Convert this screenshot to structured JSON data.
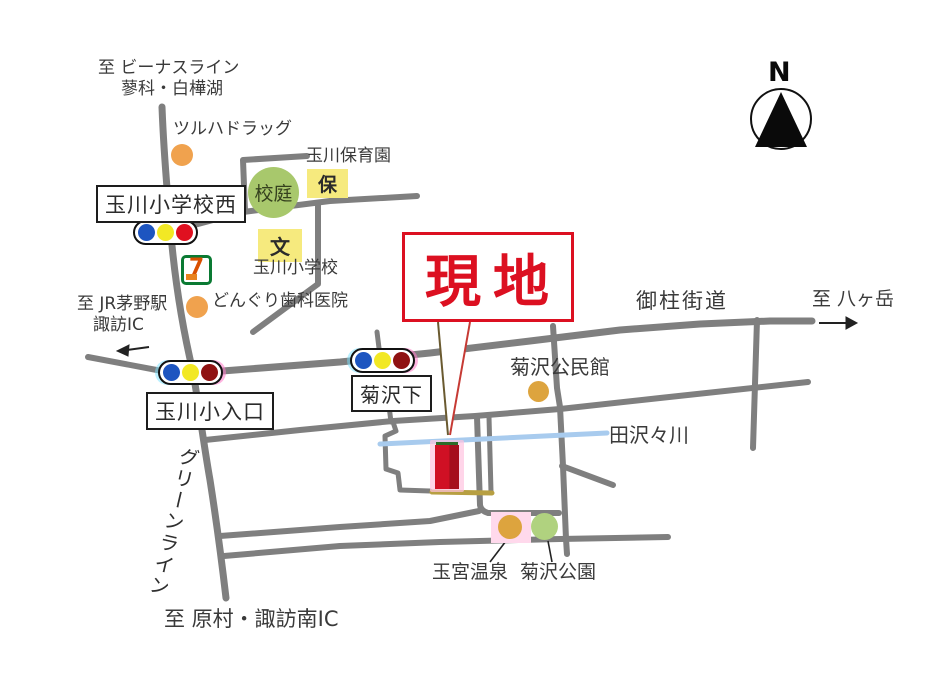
{
  "colors": {
    "ink": "#3a3a3a",
    "road": "#7f7f7f",
    "river": "#a8cbee",
    "site-red": "#dc1021",
    "site-red-dark": "#a50e1c",
    "pink": "#ffc3e0",
    "pink-light": "#ffd9ec",
    "yellow": "#f6ea7e",
    "green-circle": "#a8c86c",
    "green-circle-light": "#b0d27f",
    "orange": "#f0a24e",
    "gold": "#dda43e",
    "tan": "#b79f42",
    "dark-green": "#2d6b28",
    "signal-blue": "#1d55c0",
    "signal-yellow": "#f2e824",
    "signal-red": "#e01020",
    "signal-red-dark": "#8f1212",
    "seven-green": "#0a7a33",
    "seven-orange": "#e8821e",
    "seven-red": "#d94f00"
  },
  "compass": {
    "label": "N"
  },
  "site_callout": {
    "label": "現地"
  },
  "road_labels": {
    "onbashira": "御柱街道",
    "green_line": "グリーンライン",
    "river": "田沢々川"
  },
  "directions": {
    "venus_line_1": "至 ビーナスライン",
    "venus_line_2": "蓼科・白樺湖",
    "jr_chino_1": "至 JR茅野駅",
    "jr_chino_2": "諏訪IC",
    "yatsugatake": "至 八ヶ岳",
    "haramura": "至 原村・諏訪南IC"
  },
  "intersections": {
    "west": "玉川小学校西",
    "entrance": "玉川小入口",
    "kikusawashita": "菊沢下"
  },
  "landmarks": {
    "tsuruha": {
      "label": "ツルハドラッグ"
    },
    "hoikuen": {
      "label": "玉川保育園",
      "tag": "保"
    },
    "schoolyard": {
      "label": "校庭"
    },
    "elementary": {
      "label": "玉川小学校",
      "tag": "文"
    },
    "dental": {
      "label": "どんぐり歯科医院"
    },
    "seven_eleven": {
      "label": "7"
    },
    "kouminkan": {
      "label": "菊沢公民館"
    },
    "onsen": {
      "label": "玉宮温泉"
    },
    "park": {
      "label": "菊沢公園"
    }
  }
}
